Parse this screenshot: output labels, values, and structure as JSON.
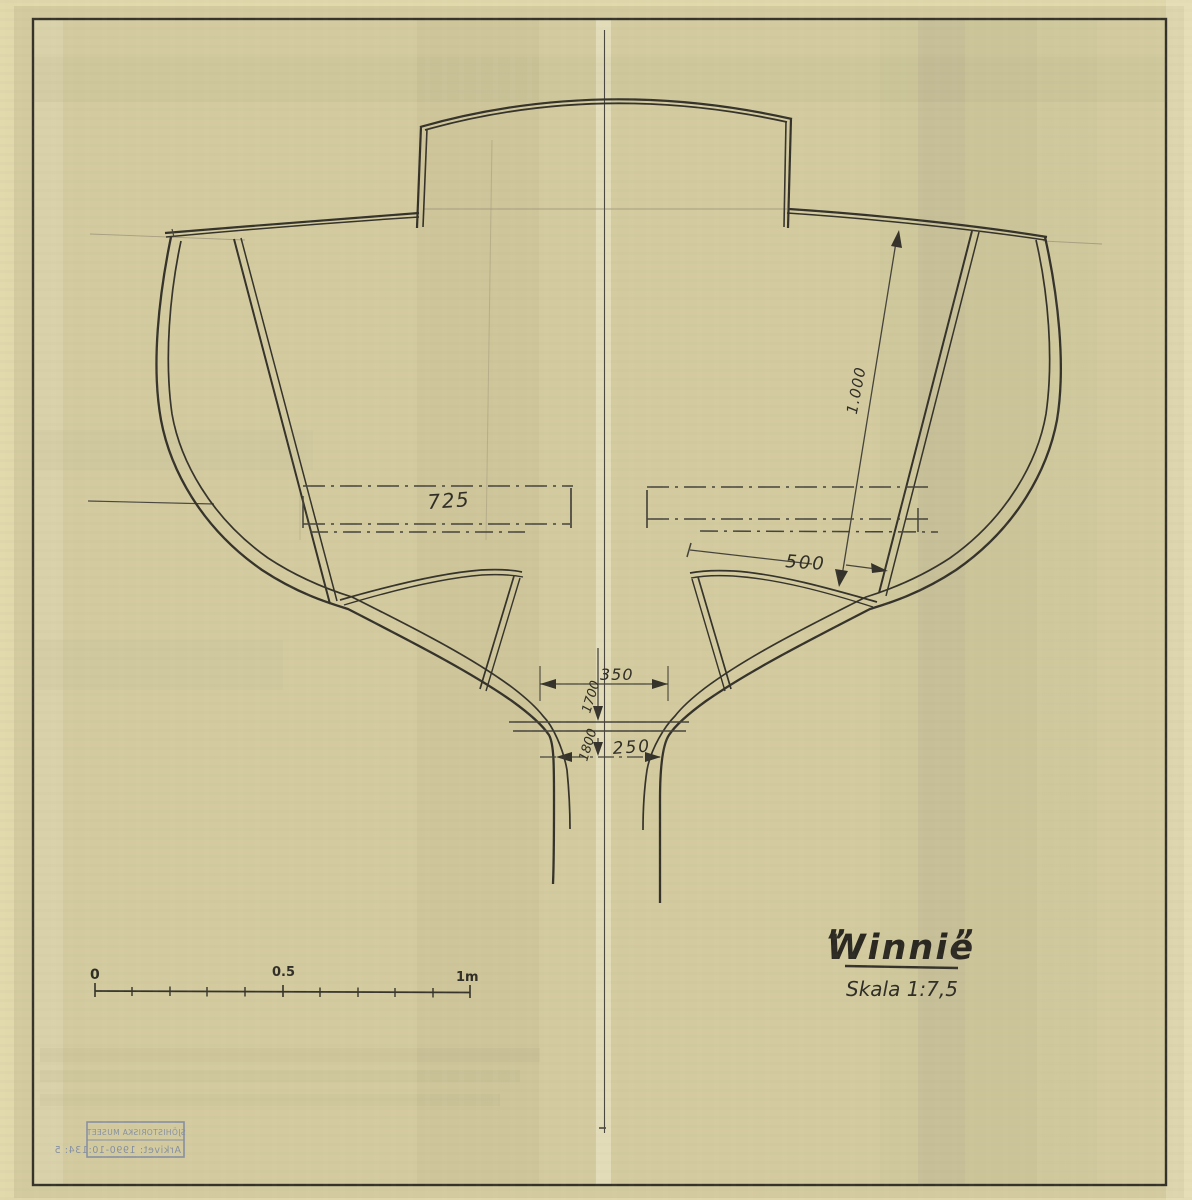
{
  "drawing_labels": {
    "d725": "725",
    "d1000": "1.000",
    "d500": "500",
    "d350": "350",
    "d1700": "1700",
    "d1800": "1800",
    "d250": "250"
  },
  "scale_bar": {
    "zero": "0",
    "half": "0.5",
    "one": "1m"
  },
  "title_block": {
    "quote_open": "”",
    "name": "Winnie",
    "quote_close": "”",
    "scale": "Skala 1:7,5"
  },
  "stamp": {
    "museum": "SJÖHISTORISKA MUSEET",
    "archive": "Arkivet: 1990-10:134: 5"
  },
  "colors": {
    "paper": "#d3cb9f",
    "paper_margin": "#e1d9ac",
    "ink": "#34322a",
    "stamp_ink": "#7381a2"
  }
}
